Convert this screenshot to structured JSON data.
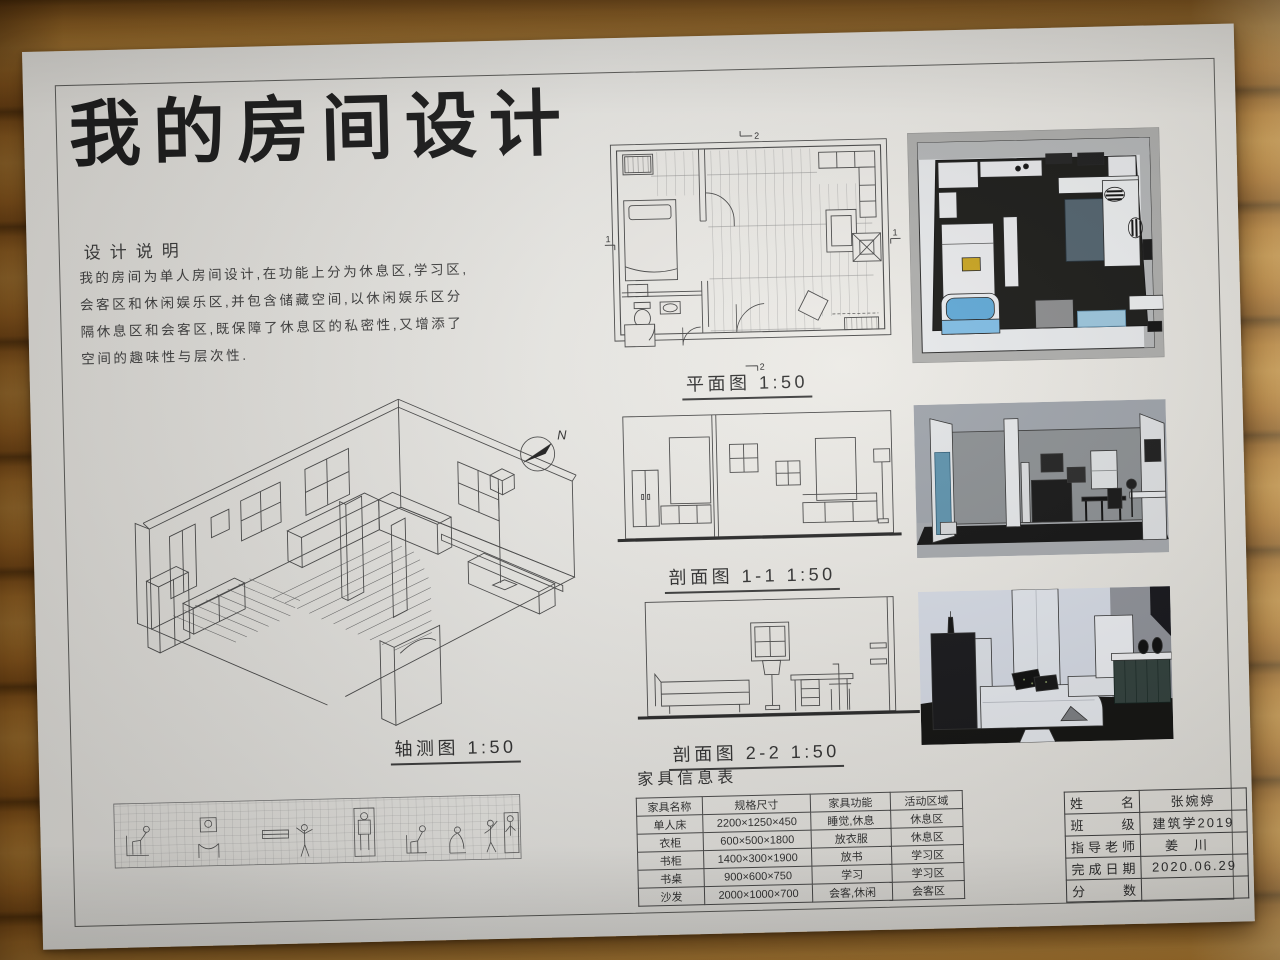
{
  "title": "我的房间设计",
  "description": {
    "heading": "设计说明",
    "lines": [
      "我的房间为单人房间设计,在功能上分为休息区,学习区,",
      "会客区和休闲娱乐区,并包含储藏空间,以休闲娱乐区分",
      "隔休息区和会客区,既保障了休息区的私密性,又增添了",
      "空间的趣味性与层次性."
    ]
  },
  "labels": {
    "plan": "平面图 1:50",
    "section1": "剖面图 1-1 1:50",
    "section2": "剖面图 2-2 1:50",
    "axon": "轴测图 1:50",
    "furniture_heading": "家具信息表"
  },
  "markers": {
    "north": "N",
    "cut1": "1",
    "cut2": "2"
  },
  "furniture_table": {
    "columns": [
      "家具名称",
      "规格尺寸",
      "家具功能",
      "活动区域"
    ],
    "rows": [
      [
        "单人床",
        "2200×1250×450",
        "睡觉,休息",
        "休息区"
      ],
      [
        "衣柜",
        "600×500×1800",
        "放衣服",
        "休息区"
      ],
      [
        "书柜",
        "1400×300×1900",
        "放书",
        "学习区"
      ],
      [
        "书桌",
        "900×600×750",
        "学习",
        "学习区"
      ],
      [
        "沙发",
        "2000×1000×700",
        "会客,休闲",
        "会客区"
      ]
    ]
  },
  "title_block": {
    "rows": [
      {
        "label": "姓名",
        "value": "张婉婷"
      },
      {
        "label": "班级",
        "value": "建筑学2019"
      },
      {
        "label": "指导老师",
        "value": "姜川"
      },
      {
        "label": "完成日期",
        "value": "2020.06.29"
      },
      {
        "label": "分数",
        "value": ""
      }
    ]
  },
  "colors": {
    "paper": "#edebe7",
    "ink": "#3a3a3a",
    "wood": "#a9712c",
    "wood_seam": "#5d3a10",
    "render_frame": "#aeaeac",
    "render_floor": "#181815",
    "render_wall": "#e9ebee",
    "tub_blue": "#5fa8d6",
    "glass_blue": "#5e93ad",
    "rug_blue": "#9cc6dd",
    "painting_yellow": "#c9a41f",
    "cabinet_teal": "#31403c"
  }
}
